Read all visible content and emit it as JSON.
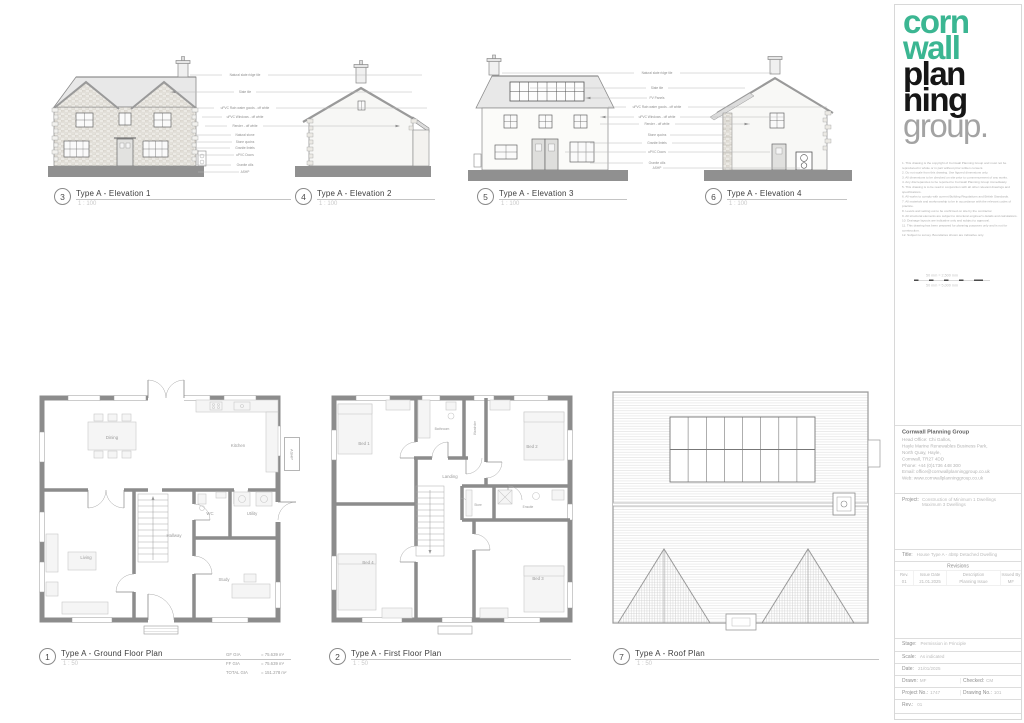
{
  "callouts": [
    {
      "num": "3",
      "title": "Type A - Elevation 1",
      "scale": "1 : 100"
    },
    {
      "num": "4",
      "title": "Type A - Elevation 2",
      "scale": "1 : 100"
    },
    {
      "num": "5",
      "title": "Type A - Elevation 3",
      "scale": "1 : 100"
    },
    {
      "num": "6",
      "title": "Type A - Elevation 4",
      "scale": "1 : 100"
    },
    {
      "num": "1",
      "title": "Type A - Ground Floor Plan",
      "scale": "1 : 50"
    },
    {
      "num": "2",
      "title": "Type A - First Floor Plan",
      "scale": "1 : 50"
    },
    {
      "num": "7",
      "title": "Type A - Roof Plan",
      "scale": "1 : 50"
    }
  ],
  "ground_floor": {
    "rooms": [
      "Dining",
      "Kitchen",
      "Living",
      "Hallway",
      "WC",
      "Utility",
      "Study"
    ],
    "ashp": "ASHP"
  },
  "first_floor": {
    "rooms": [
      "Bed 1",
      "Bathroom",
      "Wardrobe",
      "Bed 2",
      "Landing",
      "Store",
      "Ensuite",
      "Bed 4",
      "Bed 3"
    ]
  },
  "area_schedule": {
    "rows": [
      {
        "label": "GF GIA",
        "value": "=  75.639 m²"
      },
      {
        "label": "FF GIA",
        "value": "=  75.639 m²"
      },
      {
        "label": "TOTAL GIA",
        "value": "=  151.278 m²"
      }
    ]
  },
  "annotations": {
    "left": [
      "Natural slate ridge tile",
      "Slate tile",
      "uPVC Rain water goods - off white",
      "uPVC Windows - off white",
      "Render - off white",
      "Natural stone",
      "Stone quoins",
      "Granite lintels",
      "uPVC Doors",
      "Granite cills",
      "ASHP"
    ],
    "right": [
      "Natural slate ridge tile",
      "Slate tile",
      "PV Panels",
      "uPVC Rain water goods - off white",
      "uPVC Windows - off white",
      "Render - off white",
      "Stone quoins",
      "Granite lintels",
      "uPVC Doors",
      "Granite cills",
      "ASHP"
    ]
  },
  "titleblock": {
    "logo": {
      "words": [
        "corn",
        "wall",
        "plan",
        "ning",
        "group."
      ],
      "teal": "#3bb692",
      "black": "#161616",
      "grey": "#a3a3a3"
    },
    "notes": [
      "1. This drawing is the copyright of Cornwall Planning Group and must not be reproduced in whole or in part without prior written consent.",
      "2. Do not scale from this drawing. Use figured dimensions only.",
      "3. All dimensions to be checked on site prior to commencement of any works.",
      "4. Any discrepancies to be reported to Cornwall Planning Group immediately.",
      "5. This drawing is to be read in conjunction with all other relevant drawings and specifications.",
      "6. All works to comply with current Building Regulations and British Standards.",
      "7. All materials and workmanship to be in accordance with the relevant codes of practice.",
      "8. Levels and setting out to be confirmed on site by the contractor.",
      "9. All structural elements are subject to structural engineer's details and calculations.",
      "10. Drainage layouts are indicative only and subject to approval.",
      "11. This drawing has been prepared for planning purposes only and is not for construction.",
      "12. Subject to survey. Boundaries shown are indicative only."
    ],
    "scale_bar": {
      "top": "50 mm = 2,500 mm",
      "bottom": "50 mm = 5,000 mm"
    },
    "company": {
      "name": "Cornwall Planning Group",
      "address": [
        "Head Office: Chi Gallos,",
        "Hayle Marine Renewables Business Park,",
        "North Quay, Hayle,",
        "Cornwall, TR27 4DD",
        "Phone: +44 (0)1736 448 300",
        "Email: office@cornwallplanninggroup.co.uk",
        "Web: www.cornwallplanninggroup.co.uk"
      ]
    },
    "project": {
      "label": "Project:",
      "line1": "Construction of Minimum 1 Dwellings",
      "line2": "Maximum 3 Dwellings"
    },
    "drawing_title": {
      "label": "Title:",
      "value": "House Type A - 4b8p Detached Dwelling"
    },
    "revisions": {
      "header": "Revisions",
      "columns": [
        "Rev.",
        "Issue Date",
        "Description",
        "Issued By"
      ],
      "rows": [
        {
          "rev": "01",
          "date": "21.01.2025",
          "description": "Planning Issue",
          "by": "MF"
        }
      ]
    },
    "meta": {
      "stage_label": "Stage:",
      "stage_value": "Permission in Principle",
      "scale_label": "Scale:",
      "scale_value": "As indicated",
      "date_label": "Date:",
      "date_value": "21/01/2025",
      "drawn_label": "Drawn:",
      "drawn_value": "MF",
      "checked_label": "Checked:",
      "checked_value": "CM",
      "project_no_label": "Project No.:",
      "project_no_value": "1747",
      "drawing_no_label": "Drawing No.:",
      "drawing_no_value": "101",
      "rev_label": "Rev.:",
      "rev_value": "01"
    }
  }
}
